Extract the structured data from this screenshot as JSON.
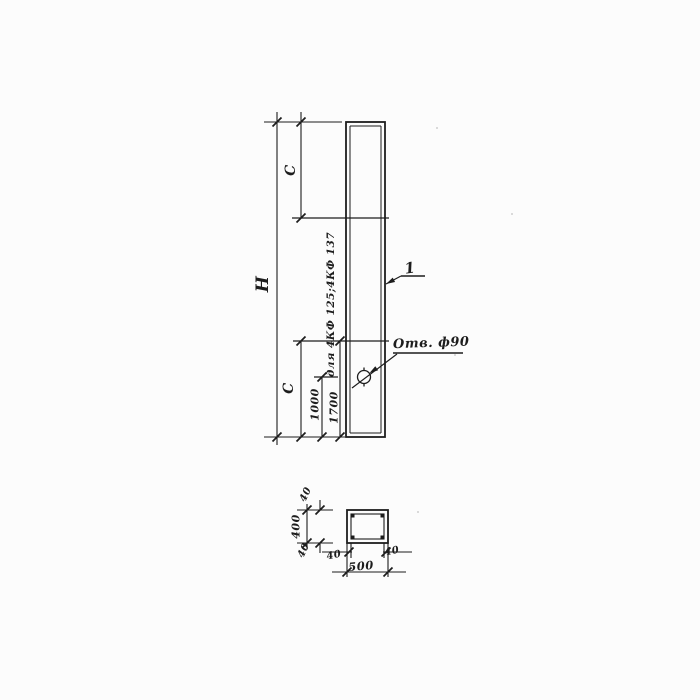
{
  "drawing": {
    "type": "engineering-drawing",
    "views": {
      "elevation": "column elevation with hole",
      "section": "hollow box cross-section with corner rebar"
    },
    "labels": {
      "overall_height": "Н",
      "c_top": "С",
      "c_bottom": "С",
      "dim_1000": "1000",
      "dim_1700": "1700",
      "note_for_types": "для 4КФ 125;4КФ 137",
      "hole_callout": "Отв. ф90",
      "position_mark": "1",
      "section_height": "400",
      "section_width": "500",
      "wall_40_top": "40",
      "wall_40_bottom": "40",
      "wall_40_left": "40",
      "wall_40_right": "40"
    },
    "colors": {
      "ink": "#1d1d1d",
      "paper": "#fcfcfc"
    }
  }
}
